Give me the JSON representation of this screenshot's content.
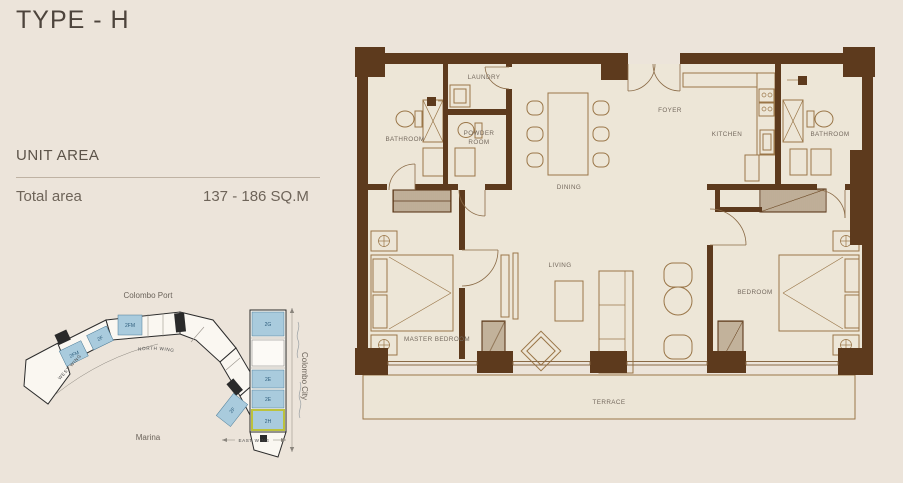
{
  "page": {
    "title": "TYPE - H",
    "background": "#ece4da"
  },
  "unit_area": {
    "heading": "UNIT AREA",
    "total_label": "Total area",
    "total_value": "137 - 186 SQ.M"
  },
  "floor_plan": {
    "wall_color": "#5d3a1d",
    "furniture_line_color": "#9a7648",
    "label_color": "#74695e",
    "rooms": [
      {
        "id": "bathroom-left",
        "label": "BATHROOM"
      },
      {
        "id": "laundry",
        "label": "LAUNDRY"
      },
      {
        "id": "powder-room",
        "line1": "POWDER",
        "line2": "ROOM"
      },
      {
        "id": "dining",
        "label": "DINING"
      },
      {
        "id": "foyer",
        "label": "FOYER"
      },
      {
        "id": "kitchen",
        "label": "KITCHEN"
      },
      {
        "id": "bathroom-right",
        "label": "BATHROOM"
      },
      {
        "id": "master-bedroom",
        "label": "MASTER BEDROOM"
      },
      {
        "id": "living",
        "label": "LIVING"
      },
      {
        "id": "bedroom",
        "label": "BEDROOM"
      },
      {
        "id": "terrace",
        "label": "TERRACE"
      }
    ]
  },
  "site_plan": {
    "unit_fill": "#a9cbdd",
    "highlight_color": "#bcc23c",
    "locations": {
      "top": "Colombo Port",
      "bottom": "Marina",
      "right": "Colombo City"
    },
    "wings": {
      "north": "NORTH WING",
      "west": "WEST WING",
      "east": "EAST WING"
    },
    "units": [
      {
        "id": "unit-2fm-west",
        "label": "2FM",
        "highlighted": false
      },
      {
        "id": "unit-2f-west",
        "label": "2F",
        "highlighted": false
      },
      {
        "id": "unit-2fm-north",
        "label": "2FM",
        "highlighted": false
      },
      {
        "id": "unit-2g",
        "label": "2G",
        "highlighted": false
      },
      {
        "id": "unit-2e-upper",
        "label": "2E",
        "highlighted": false
      },
      {
        "id": "unit-2e-lower",
        "label": "2E",
        "highlighted": false
      },
      {
        "id": "unit-2h",
        "label": "2H",
        "highlighted": true
      },
      {
        "id": "unit-2f-east",
        "label": "2F",
        "highlighted": false
      }
    ]
  }
}
